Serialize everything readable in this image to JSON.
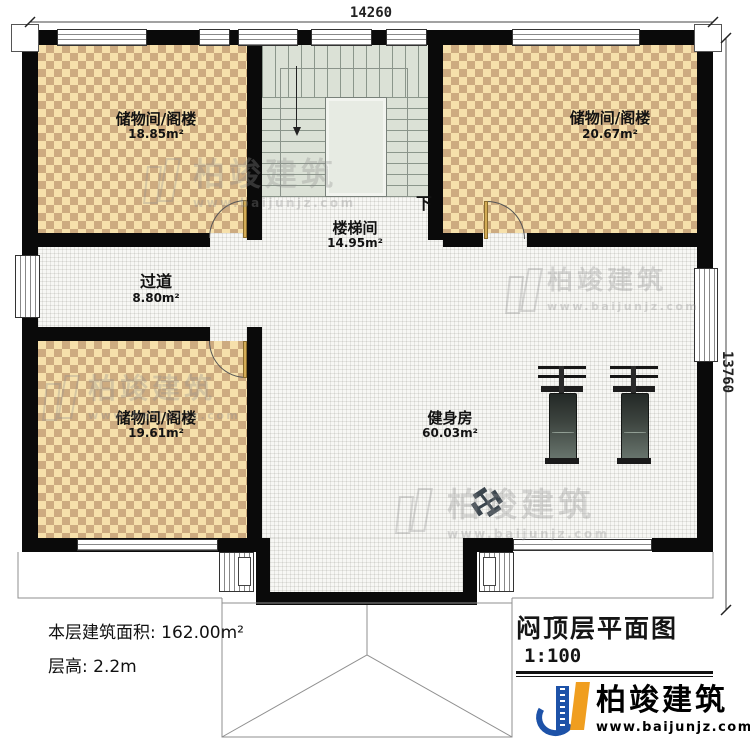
{
  "dims": {
    "top": "14260",
    "right": "13760"
  },
  "rooms": {
    "storage_tl": {
      "name": "储物间/阁楼",
      "area": "18.85m²"
    },
    "storage_tr": {
      "name": "储物间/阁楼",
      "area": "20.67m²"
    },
    "storage_bl": {
      "name": "储物间/阁楼",
      "area": "19.61m²"
    },
    "stairwell": {
      "name": "楼梯间",
      "area": "14.95m²",
      "down": "下"
    },
    "corridor": {
      "name": "过道",
      "area": "8.80m²"
    },
    "gym": {
      "name": "健身房",
      "area": "60.03m²"
    }
  },
  "notes": {
    "area_label": "本层建筑面积:",
    "area_value": "162.00m²",
    "height_label": "层高:",
    "height_value": "2.2m"
  },
  "title_block": {
    "title": "闷顶层平面图",
    "scale": "1:100"
  },
  "brand": {
    "name": "柏竣建筑",
    "site": "www.baijunjz.com"
  },
  "watermark": {
    "name": "柏竣建筑",
    "site": "www.baijunjz.com"
  },
  "colors": {
    "wall": "#0a0a0a",
    "room_floor_light": "#f6e0ab",
    "room_floor_dark": "#cdab80",
    "stair_floor": "#dbe1d6",
    "logo_blue": "#1d52a8",
    "logo_orange": "#f09e1f"
  }
}
